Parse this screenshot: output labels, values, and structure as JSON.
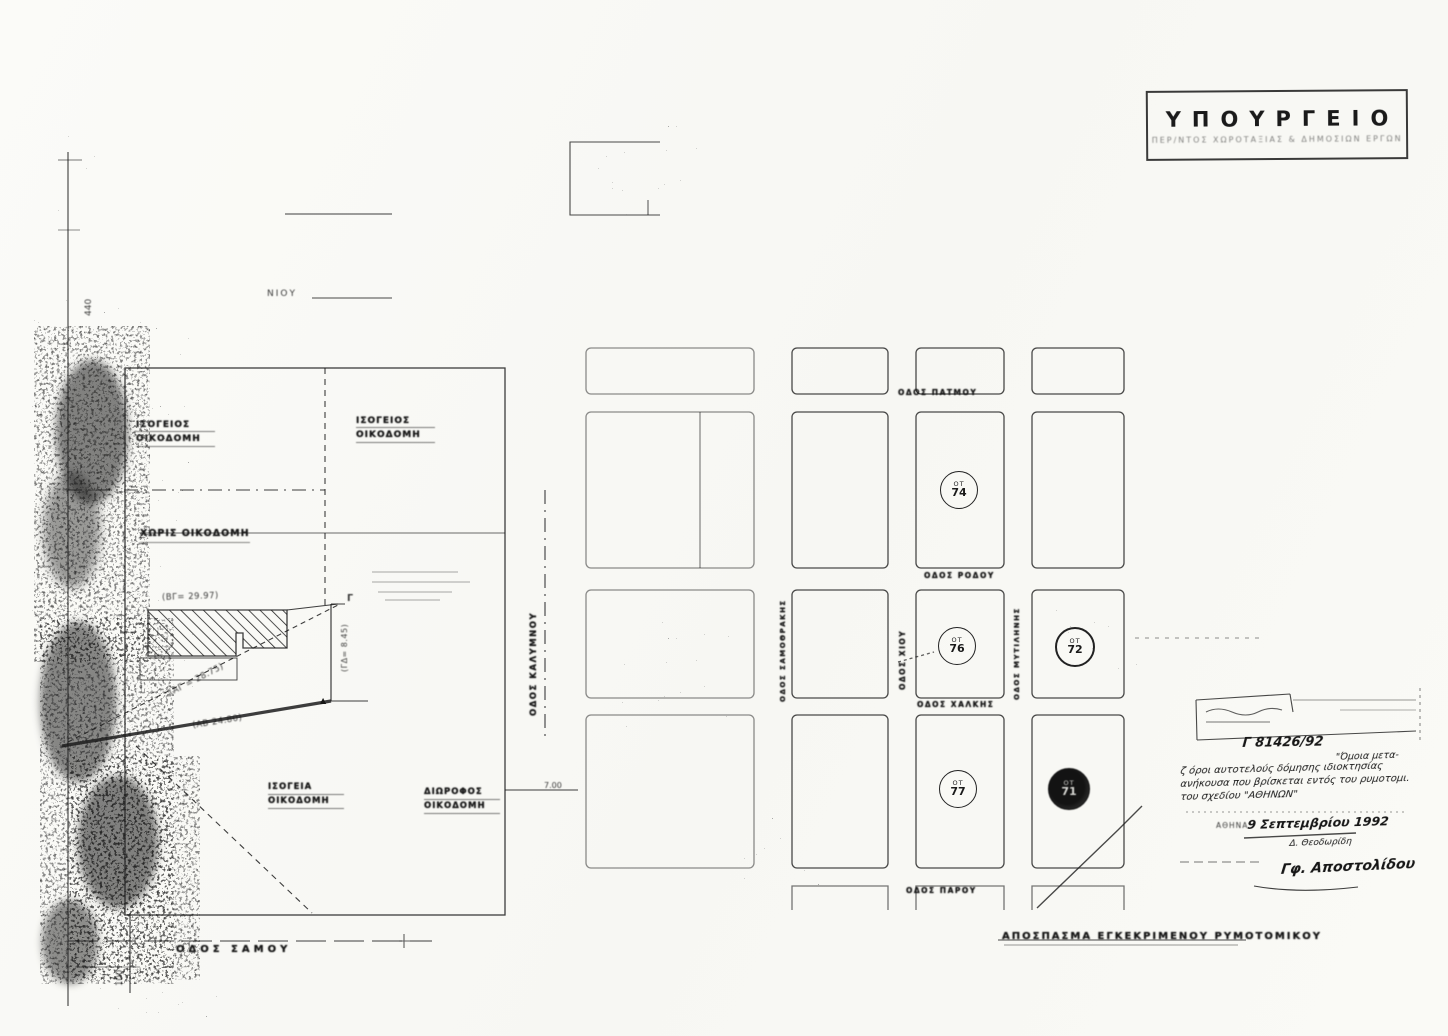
{
  "stamp": {
    "title": "ΥΠΟΥΡΓΕΙΟ",
    "subtitle": "ΠΕΡ/ΝΤΟΣ  ΧΩΡΟΤΑΞΙΑΣ  &  ΔΗΜΟΣΙΩΝ  ΕΡΓΩΝ"
  },
  "left_map": {
    "fragment_top": "ΝΙΟΥ",
    "axis_top": "440",
    "axis_bottom": "100",
    "road_width": "7.00",
    "labels": {
      "tl1": "ΙΣΟΓΕΙΟΣ",
      "tl2": "ΟΙΚΟΔΟΜΗ",
      "tr1": "ΙΣΟΓΕΙΟΣ",
      "tr2": "ΟΙΚΟΔΟΜΗ",
      "mid": "ΧΩΡΙΣ ΟΙΚΟΔΟΜΗ",
      "bl1": "ΙΣΟΓΕΙΑ",
      "bl2": "ΟΙΚΟΔΟΜΗ",
      "br1": "ΔΙΩΡΟΦΟΣ",
      "br2": "ΟΙΚΟΔΟΜΗ"
    },
    "measurements": {
      "bg": "(ΒΓ= 29.97)",
      "ag": "(ΑΓ = 28.75)",
      "ab": "(ΑΒ  24.80)",
      "gd": "(ΓΔ= 8.45)",
      "point_g": "Γ",
      "point_d": "▲"
    },
    "streets": {
      "bottom": "ΟΔΟΣ   ΣΑΜΟΥ",
      "corridor": "ΟΔΟΣ ΚΑΛΥΜΝΟΥ"
    }
  },
  "grid_map": {
    "streets": {
      "top": "ΟΔΟΣ ΠΑΤΜΟΥ",
      "mid": "ΟΔΟΣ ΡΟΔΟΥ",
      "lower": "ΟΔΟΣ ΧΑΛΚΗΣ",
      "bottom": "ΟΔΟΣ ΠΑΡΟΥ",
      "v_left": "ΟΔΟΣ ΣΑΜΟΘΡΑΚΗΣ",
      "v_mid": "ΟΔΟΣ ΧΙΟΥ",
      "v_right": "ΟΔΟΣ ΜΥΤΙΛΗΝΗΣ"
    },
    "blocks": [
      {
        "id": "ΟΤ",
        "num": "74"
      },
      {
        "id": "ΟΤ",
        "num": "76"
      },
      {
        "id": "ΟΤ",
        "num": "72"
      },
      {
        "id": "ΟΤ",
        "num": "77"
      },
      {
        "id": "ΟΤ",
        "num": "71"
      }
    ]
  },
  "annotations": {
    "protocol": "Γ 81426/92",
    "note_fragment": "\"Όμοια μετα-",
    "note_lines": [
      "ζ όροι αυτοτελούς δόμησης ιδιοκτησίας",
      "ανήκουσα που βρίσκεται εντός του ρυμοτομι.",
      "του σχεδίου \"ΑΘΗΝΩΝ\""
    ],
    "city": "ΑΘΗΝΑ",
    "date": "9 Σεπτεμβρίου 1992",
    "officer": "Δ. Θεοδωρίδη",
    "signature": "Γφ. Αποστολίδου",
    "caption": "ΑΠΟΣΠΑΣΜΑ  ΕΓΚΕΚΡΙΜΕΝΟΥ  ΡΥΜΟΤΟΜΙΚΟΥ"
  }
}
